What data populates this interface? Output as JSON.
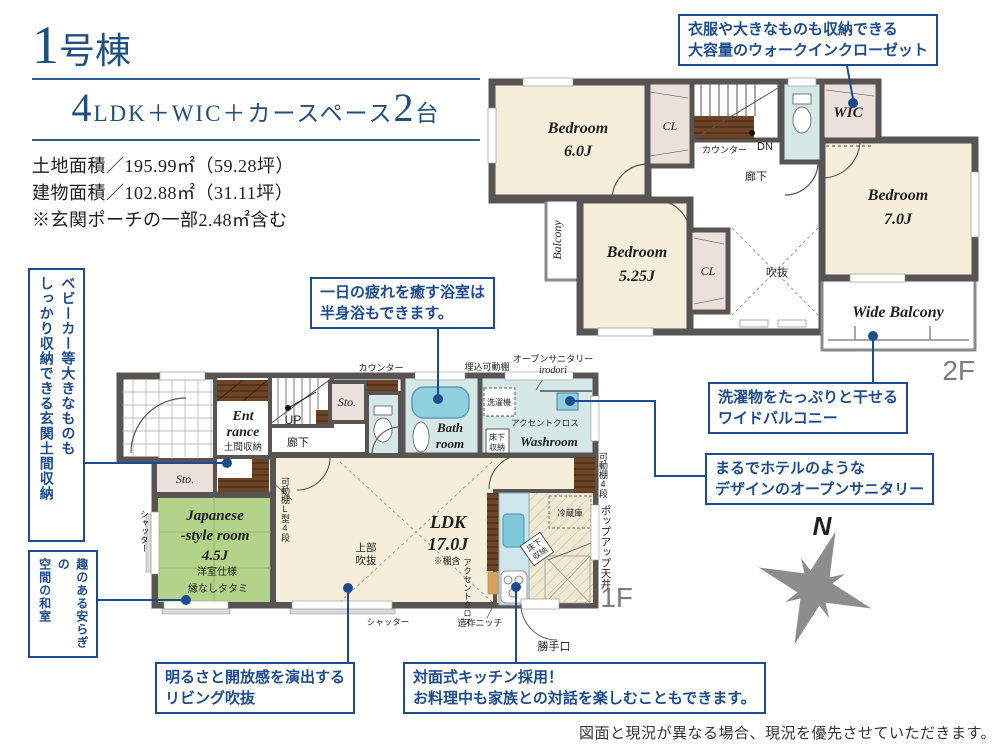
{
  "header": {
    "title_num": "1",
    "title_suffix": "号棟",
    "plan_num1": "4",
    "plan_text1": "LDK＋WIC＋カースペース",
    "plan_num2": "2",
    "plan_text2": "台",
    "area1": "土地面積／195.99㎡（59.28坪）",
    "area2": "建物面積／102.88㎡（31.11坪）",
    "area3": "※玄関ポーチの一部2.48㎡含む"
  },
  "callouts": {
    "wic1": "衣服や大きなものも収納できる",
    "wic2": "大容量のウォークインクローゼット",
    "bath1": "一日の疲れを癒す浴室は",
    "bath2": "半身浴もできます。",
    "balcony1": "洗濯物をたっぷりと干せる",
    "balcony2": "ワイドバルコニー",
    "sanitary1": "まるでホテルのような",
    "sanitary2": "デザインのオープンサニタリー",
    "living1": "明るさと開放感を演出する",
    "living2": "リビング吹抜",
    "kitchen1": "対面式キッチン採用！",
    "kitchen2": "お料理中も家族との対話を楽しむこともできます。",
    "genkan1": "ベビーカー等大きなものも",
    "genkan2": "しっかり収納できる玄関土間収納",
    "washitsu1": "趣のある安らぎの",
    "washitsu2": "空間の和室"
  },
  "f2": {
    "label": "2F",
    "bed6a": "Bedroom",
    "bed6b": "6.0J",
    "bed5a": "Bedroom",
    "bed5b": "5.25J",
    "bed7a": "Bedroom",
    "bed7b": "7.0J",
    "wic": "WIC",
    "cl1": "CL",
    "cl2": "CL",
    "balcony": "Balcony",
    "wide_balcony": "Wide Balcony",
    "void": "吹抜",
    "hall": "廊下",
    "counter": "カウンター",
    "dn": "DN"
  },
  "f1": {
    "label": "1F",
    "ent1": "Ent",
    "ent2": "rance",
    "doma": "土間収納",
    "up": "UP",
    "hall": "廊下",
    "sto1": "Sto.",
    "sto2": "Sto.",
    "counter": "カウンター",
    "recessed": "埋込可動棚",
    "sanitary1": "オープンサニタリー",
    "sanitary2": "irodori",
    "laundry": "洗濯機",
    "accent1": "アクセントクロス",
    "uf1a": "床下",
    "uf1b": "収納",
    "bath1": "Bath",
    "bath2": "room",
    "washroom": "Washroom",
    "shelf4": "可動棚4段",
    "shelfL": "可動棚L型4段",
    "jp1": "Japanese",
    "jp2": "-style room",
    "jp3": "4.5J",
    "jp4": "洋室仕様",
    "jp5": "縁なしタタミ",
    "shutter_l": "シャッター",
    "shutter_b": "シャッター",
    "ldk1": "LDK",
    "ldk2": "17.0J",
    "ldk3": "※棚含",
    "void1": "上部",
    "void2": "吹抜",
    "fridge": "冷蔵庫",
    "popup": "ポップアップ天井",
    "accent2": "アクセントクロス",
    "uf2a": "床下",
    "uf2b": "収納",
    "niche": "造作ニッチ",
    "backdoor": "勝手口"
  },
  "compass": {
    "label": "N"
  },
  "disclaimer": "図面と現況が異なる場合、現況を優先させていただきます。",
  "colors": {
    "accent_blue": "#1c4c8d",
    "title_navy": "#20507f",
    "wall": "#595454",
    "room_cream": "#f4eedb",
    "closet_pink": "#ece1da",
    "tatami_green": "#b3d38b",
    "wet_blue": "#d6e7e7",
    "tub_blue": "#8fd0e0",
    "wood_brown": "#6e4426",
    "compass_gray": "#8d8d8d"
  }
}
